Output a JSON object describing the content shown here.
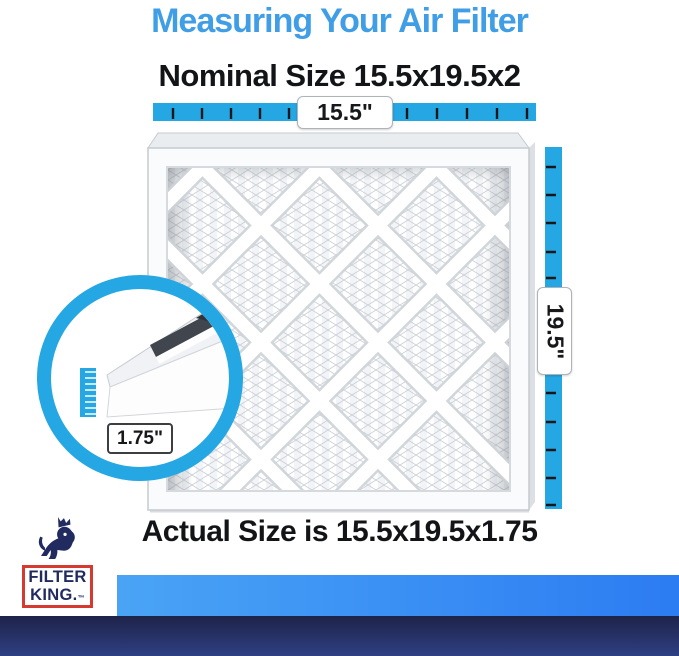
{
  "header": {
    "title": "Measuring Your Air Filter",
    "nominal_size": "Nominal Size 15.5x19.5x2"
  },
  "measurements": {
    "width": "15.5\"",
    "height": "19.5\"",
    "depth": "1.75\""
  },
  "footer": {
    "actual_size": "Actual Size is 15.5x19.5x1.75"
  },
  "logo": {
    "line1": "FILTER",
    "line2": "KING.",
    "trademark": "™"
  },
  "colors": {
    "accent": "#25a7e3",
    "title": "#3f9ee6",
    "text": "#121417",
    "bar1": "#4aa4f5",
    "bar2": "#2c7cf2",
    "navy1": "#1e2349",
    "navy2": "#2e3f82",
    "logo_navy": "#212b5f",
    "logo_red": "#d6392f"
  }
}
